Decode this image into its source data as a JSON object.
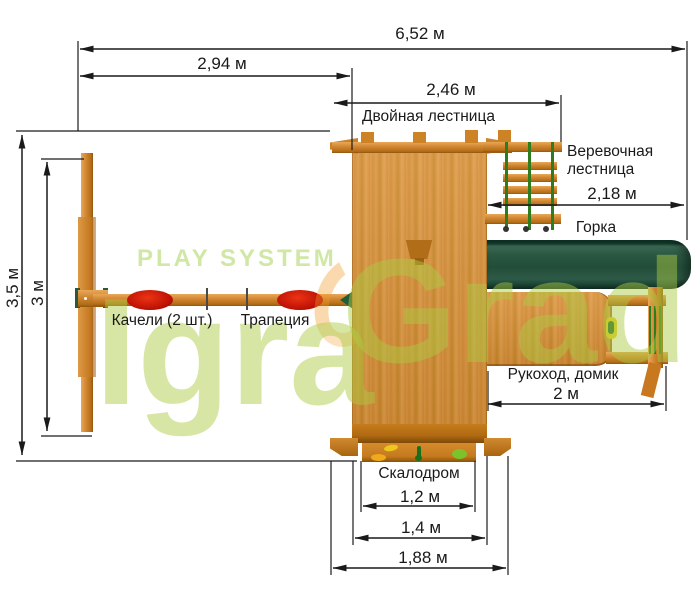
{
  "watermark": {
    "brand_top": "PLAY SYSTEM",
    "brand_part1": "Igra",
    "brand_part2": "Grad"
  },
  "dimensions": {
    "overall_length": "6,52 м",
    "swing_section_length": "2,94 м",
    "double_ladder_length": "2,46 м",
    "rope_ladder_slide_length": "2,18 м",
    "monkey_bars_length": "2 м",
    "climbing_wall_width": "1,2 м",
    "climbing_wall_outer_width": "1,4 м",
    "platform_width": "1,88 м",
    "overall_depth": "3,5 м",
    "swing_frame_depth": "3 м"
  },
  "labels": {
    "double_ladder": "Двойная лестница",
    "rope_ladder": "Веревочная лестница",
    "slide": "Горка",
    "swings": "Качели (2 шт.)",
    "trapeze": "Трапеция",
    "monkey_bars_house": "Рукоход, домик",
    "climbing_wall": "Скалодром"
  },
  "colors": {
    "background": "#ffffff",
    "wood": "#d6913c",
    "wood_dark": "#9c5a14",
    "slide_green": "#2c5847",
    "rope_green": "#2e7c1e",
    "swing_seat_red": "#c01205",
    "watermark_green": "#accb42",
    "dimension_line": "#1a1a1a"
  }
}
